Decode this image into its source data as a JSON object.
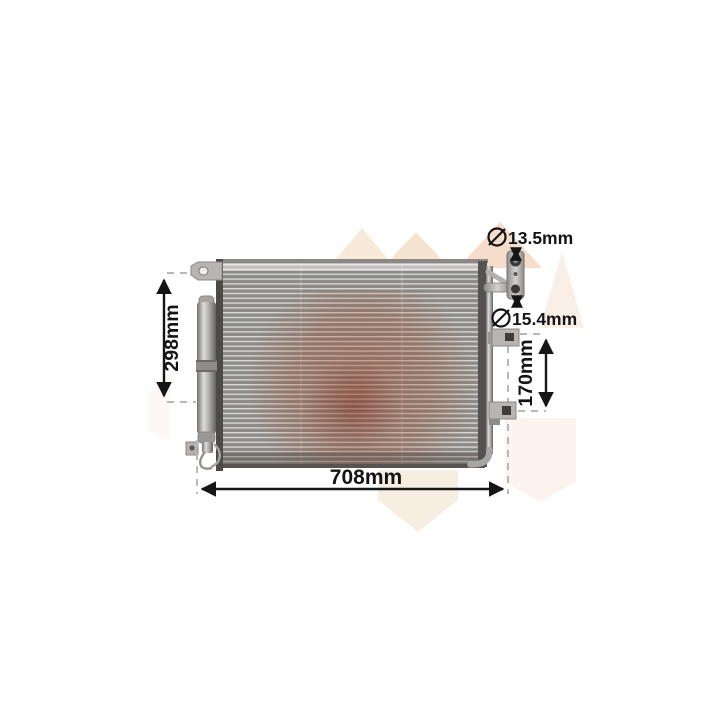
{
  "image": {
    "type": "product-dimension-diagram",
    "subject": "air-conditioning-condenser-with-receiver-drier",
    "background": "#ffffff"
  },
  "annotations": {
    "width": {
      "label": "708mm"
    },
    "height": {
      "label": "298mm"
    },
    "bracket_span": {
      "label": "170mm"
    },
    "port_top": {
      "symbol": "diameter",
      "label": "13.5mm"
    },
    "port_bottom": {
      "symbol": "diameter",
      "label": "15.4mm"
    }
  },
  "colors": {
    "annotation_text": "#141414",
    "extension_dash": "#b8b8b8",
    "fin_dark": "#8e8b88",
    "fin_light": "#d8d6d3",
    "frame_dark": "#4d4a47",
    "metal_light": "#c9c7c4",
    "watermark_cream": "#f6e9da",
    "watermark_peach": "#f5dccb",
    "watermark_tint": "#a5522d"
  }
}
